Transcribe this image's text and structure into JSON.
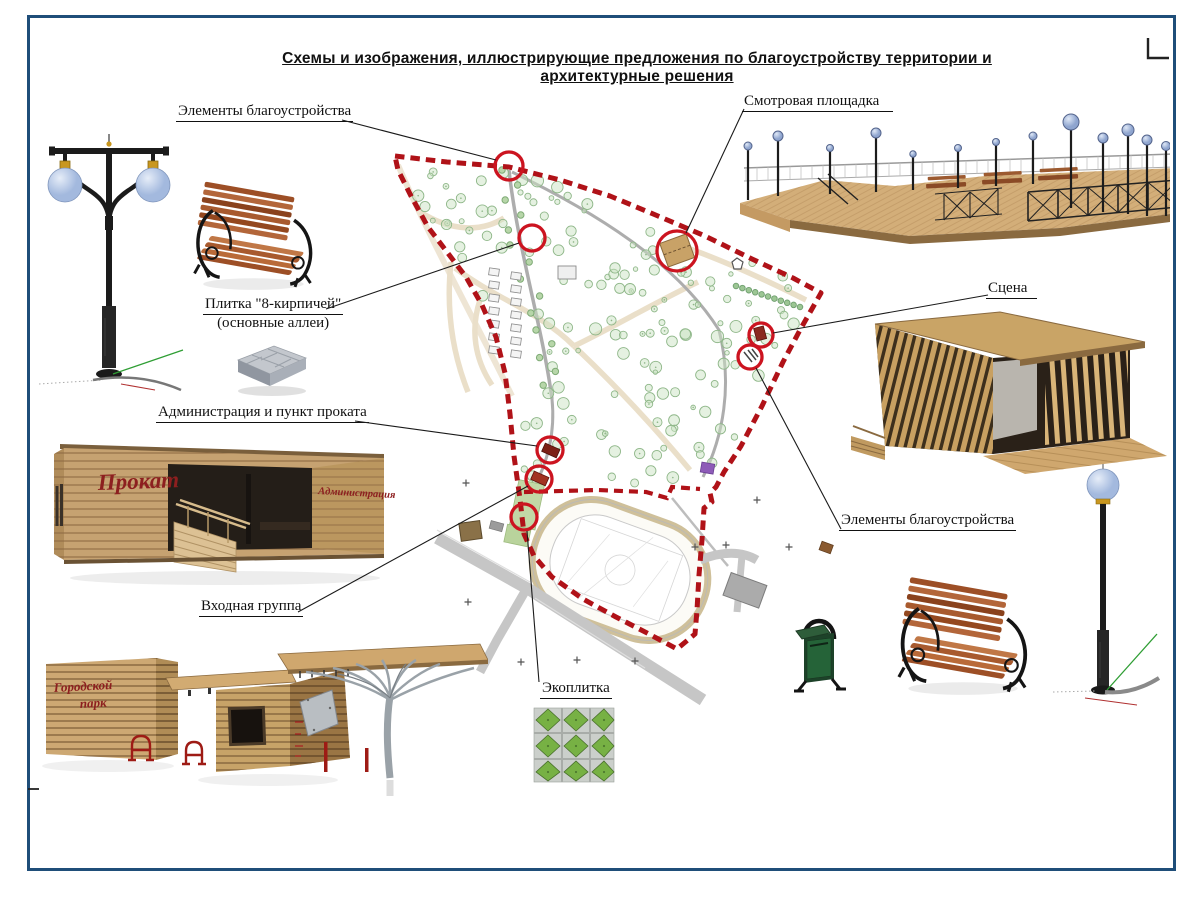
{
  "title": "Схемы и изображения, иллюстрирующие предложения по благоустройству территории и архитектурные решения",
  "callouts": {
    "elements_top": "Элементы благоустройства",
    "viewing_platform": "Смотровая площадка",
    "tile_name": "Плитка \"8-кирпичей\"",
    "tile_sub": "(основные аллеи)",
    "administration": "Администрация и пункт проката",
    "stage": "Сцена",
    "elements_right": "Элементы благоустройства",
    "entrance_group": "Входная группа",
    "eco_tile": "Экоплитка"
  },
  "renders": {
    "admin_building": {
      "left_sign": "Прокат",
      "right_sign": "Администрация"
    },
    "entrance_cube": {
      "line1": "Городской",
      "line2": "парк"
    }
  },
  "colors": {
    "frame_blue": "#1f4e79",
    "boundary_red": "#b01218",
    "marker_red": "#cc1420",
    "wood_tan": "#c9a66f",
    "wood_dark": "#8a6a40",
    "lamp_globe_blue": "#b9c9e6",
    "bin_green": "#1d4229",
    "eco_green": "#77b144",
    "map_tree_green": "#8fb789",
    "path_gray": "#adadad",
    "path_beige": "#eadfc9"
  }
}
